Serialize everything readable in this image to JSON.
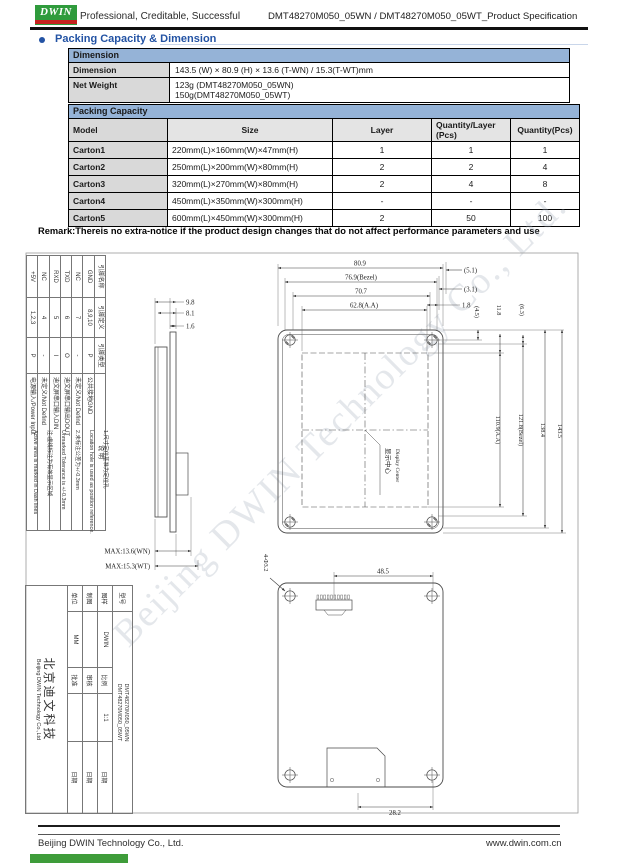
{
  "header": {
    "logo_text": "DWIN",
    "tagline": "Professional, Creditable, Successful",
    "doc_title": "DMT48270M050_05WN / DMT48270M050_05WT_Product Specification"
  },
  "section": {
    "title": "Packing Capacity & Dimension"
  },
  "dimension_table": {
    "title": "Dimension",
    "dim_label": "Dimension",
    "dim_value": "143.5 (W) × 80.9 (H) × 13.6 (T-WN) / 15.3(T-WT)mm",
    "weight_label": "Net Weight",
    "weight_line1": "123g (DMT48270M050_05WN)",
    "weight_line2": "150g(DMT48270M050_05WT)"
  },
  "packing_table": {
    "title": "Packing Capacity",
    "col_model": "Model",
    "col_size": "Size",
    "col_layer": "Layer",
    "col_qty_layer_1": "Quantity/Layer",
    "col_qty_layer_2": "(Pcs)",
    "col_qty": "Quantity(Pcs)",
    "rows": [
      {
        "model": "Carton1",
        "size": "220mm(L)×160mm(W)×47mm(H)",
        "layer": "1",
        "qty_layer": "1",
        "qty": "1"
      },
      {
        "model": "Carton2",
        "size": "250mm(L)×200mm(W)×80mm(H)",
        "layer": "2",
        "qty_layer": "2",
        "qty": "4"
      },
      {
        "model": "Carton3",
        "size": "320mm(L)×270mm(W)×80mm(H)",
        "layer": "2",
        "qty_layer": "4",
        "qty": "8"
      },
      {
        "model": "Carton4",
        "size": "450mm(L)×350mm(W)×300mm(H)",
        "layer": "-",
        "qty_layer": "-",
        "qty": "-"
      },
      {
        "model": "Carton5",
        "size": "600mm(L)×450mm(W)×300mm(H)",
        "layer": "2",
        "qty_layer": "50",
        "qty": "100"
      }
    ]
  },
  "remark": "Remark:Thereis no extra-notice if the product design changes that do not affect performance parameters and use",
  "drawing": {
    "pin_table": {
      "headers": [
        "引脚名称",
        "引脚定义",
        "引脚类型",
        "说 明"
      ],
      "pins": [
        {
          "name": "GND",
          "def": "8,9,10",
          "type": "P",
          "desc": "公共接地GND"
        },
        {
          "name": "NC",
          "def": "7",
          "type": "-",
          "desc": "未定义/Not Defind"
        },
        {
          "name": "TXD",
          "def": "6",
          "type": "O",
          "desc": "迪文屏串口输出DOUT"
        },
        {
          "name": "RXD",
          "def": "5",
          "type": "I",
          "desc": "迪文屏串口输入DIN"
        },
        {
          "name": "NC",
          "def": "4",
          "type": "-",
          "desc": "未定义/Not Defind"
        },
        {
          "name": "+5V",
          "def": "1,2,3",
          "type": "P",
          "desc": "电源输入/Power Input"
        }
      ]
    },
    "notes": [
      "1.尺寸定位基准为定位孔",
      "Location hole is used as position reference.",
      "2.未标注公差为+/-0.3mm",
      "Unmarked Tolerance is +/-0.3mm",
      "注:虚线标注为有效显示区域",
      "Active area is marked in Dash lines"
    ],
    "side_view": {
      "dims": [
        "9.8",
        "8.1",
        "1.6"
      ],
      "max_wn": "MAX:13.6(WN)",
      "max_wt": "MAX:15.3(WT)"
    },
    "front_view": {
      "top_dims": [
        "80.9",
        "76.9(Bezel)",
        "70.7",
        "62.8(A.A)"
      ],
      "corner_dims": [
        "(5.1)",
        "(3.1)",
        "1.8"
      ],
      "small_v_dims": [
        "(4.5)",
        "11.8",
        "(6.3)"
      ],
      "right_dims": [
        "110.9(A.A)",
        "121.8(Bezel)",
        "138.4",
        "143.5"
      ],
      "center_label_cn": "显示中心",
      "center_label_en": "Display Center"
    },
    "back_view": {
      "top_dim": "48.5",
      "hole_label": "4-Φ3.2",
      "bottom_dim": "28.2"
    },
    "title_block": {
      "model_label": "型号",
      "model_1": "DMT48270M050_05WN",
      "model_2": "DMT48270M050_05WT",
      "r2c1": "图样",
      "r2c2": "DWIN",
      "r2c3": "比例",
      "r2c4": "1:1",
      "r2c5": "日期",
      "r3c1": "制图",
      "r3c2": "",
      "r3c3": "审核",
      "r3c4": "",
      "r3c5": "日期",
      "r4c1": "单位",
      "r4c2": "MM",
      "r4c3": "批准",
      "r4c4": "",
      "r4c5": "日期",
      "company_cn": "北京迪文科技",
      "company_en": "Beijing DWIN Technology Co.,Ltd"
    }
  },
  "watermark": "Beijing DWIN Technology Co., Ltd.",
  "footer": {
    "company": "Beijing DWIN Technology Co., Ltd.",
    "website": "www.dwin.com.cn"
  },
  "colors": {
    "table_header_blue": "#95B3D7",
    "row_gray": "#D9D9D9",
    "accent_blue": "#2353A4",
    "logo_green": "#2F9B3C",
    "logo_red": "#C6231F"
  }
}
